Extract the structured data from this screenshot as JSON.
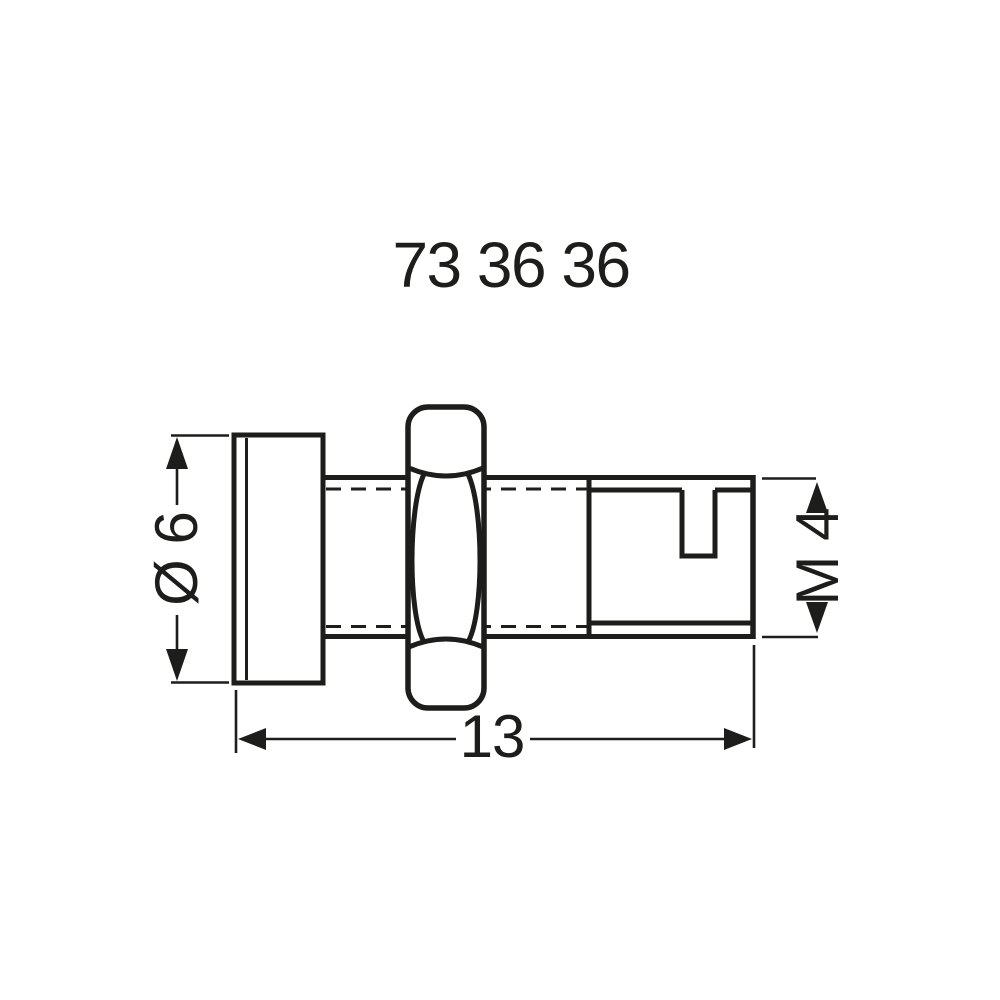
{
  "page": {
    "background_color": "#ffffff",
    "line_color": "#1d1d1b"
  },
  "title": {
    "product_number": "73 36 36"
  },
  "dimensions": {
    "diameter_label": "Ø 6",
    "thread_label": "M 4",
    "length_label": "13"
  }
}
